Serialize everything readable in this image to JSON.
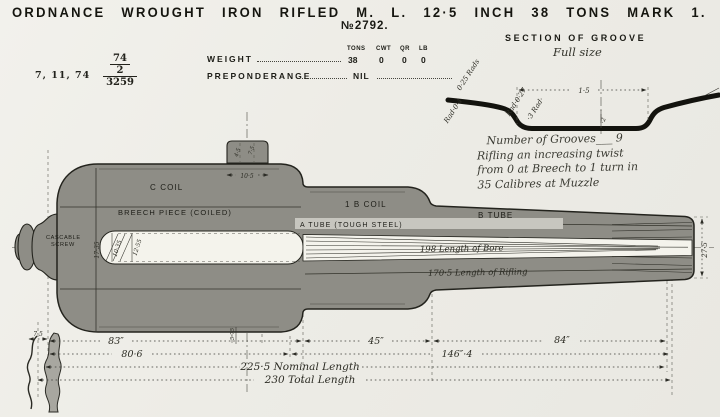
{
  "title": "ORDNANCE WROUGHT IRON RIFLED M. L. 12·5 INCH 38 TONS MARK 1.",
  "serial": "№2792.",
  "stamp": {
    "date": "7, 11, 74",
    "frac_top": "74",
    "frac_mid": "2",
    "frac_bottom": "3259"
  },
  "weight_table": {
    "weight_label": "WEIGHT",
    "columns": [
      "TONS",
      "CWT",
      "QR",
      "LB"
    ],
    "values": [
      "38",
      "0",
      "0",
      "0"
    ],
    "preponderance_label": "PREPONDERANGE",
    "preponderance_value": "NIL"
  },
  "groove_section": {
    "title": "SECTION OF GROOVE",
    "subtitle": "Full size",
    "width_dim": "1·5",
    "depth_dim": "·2",
    "rad_labels": [
      "0·25 Rads",
      "Rad·0·4",
      "Rad·0·27",
      "·3 Rad·"
    ]
  },
  "note": {
    "line1": "Number of Grooves___ 9",
    "line2": "Rifling an increasing twist",
    "line3": "from 0 at Breech to 1 turn in",
    "line4": "35 Calibres at Muzzle"
  },
  "gun": {
    "c_coil": "C COIL",
    "breech_piece": "BREECH PIECE (COILED)",
    "b1_coil": "1 B COIL",
    "a_tube": "A TUBE (TOUGH STEEL)",
    "b_tube": "B TUBE",
    "cascable_line1": "CASCABLE",
    "cascable_line2": "SCREW",
    "bore_length": "198 Length of Bore",
    "rifling_length": "170·5 Length of Rifling",
    "muzzle_dia": "27·5",
    "chamber_dims": [
      "17·35",
      "10·35",
      "12·55"
    ],
    "top_dim": "10·5",
    "top_small": [
      "4·5",
      "7·5"
    ],
    "mid_small": "5·75"
  },
  "dimensions": {
    "d83": "83″",
    "d45": "45″",
    "d84": "84″",
    "d806": "80·6",
    "d1464": "146″·4",
    "nominal": "225·5 Nominal Length",
    "total": "230 Total Length",
    "d75": "7·5"
  },
  "colors": {
    "paper": "#edece6",
    "ink": "#1d1d17",
    "gun_fill": "#8e8d86"
  }
}
